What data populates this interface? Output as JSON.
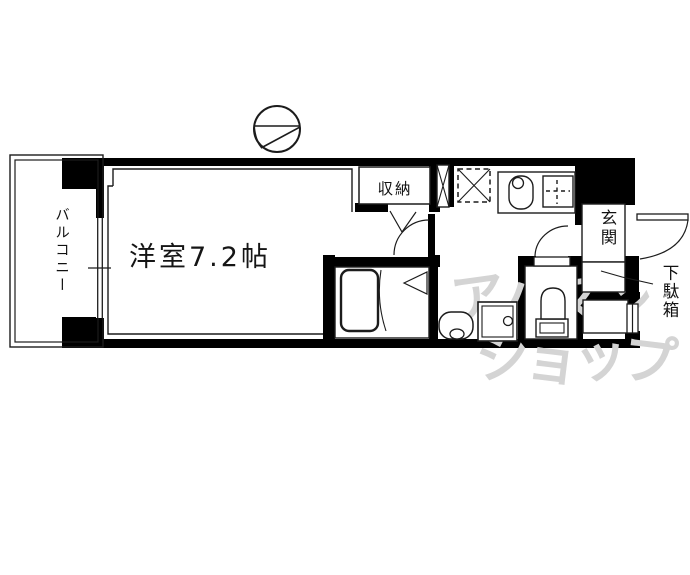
{
  "floorplan": {
    "rooms": {
      "balcony_label": "バルコニー",
      "main_room_label": "洋室7.2帖",
      "closet_label": "収納",
      "entrance_label": "玄関",
      "shoe_cabinet_label": "下駄箱"
    },
    "watermark": {
      "line1": "アパマン",
      "line2": "ショップ"
    },
    "colors": {
      "wall": "#000000",
      "line": "#1c1c1c",
      "background": "#ffffff",
      "watermark": "#d4d4d4"
    },
    "icons": {
      "compass": "north-compass-icon",
      "bathtub": "bathtub-icon",
      "toilet": "toilet-icon",
      "sink": "kitchen-sink-icon",
      "stove": "stove-icon",
      "washbasin": "washbasin-icon"
    }
  }
}
